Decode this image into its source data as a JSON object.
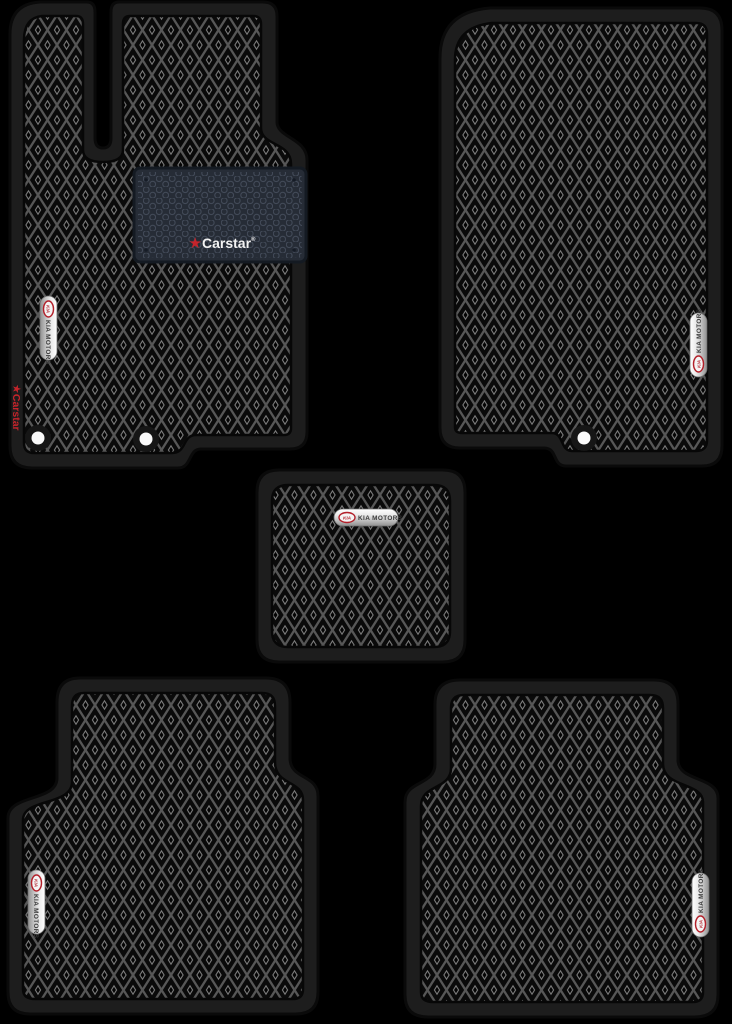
{
  "product": {
    "title": "EVA car floor mat set (5 pieces)"
  },
  "badges": {
    "kia": "KIA",
    "kia_motors": "KIA MOTORS"
  },
  "heel_pad_logo": {
    "star": "★",
    "text": "Carstar",
    "reg": "®"
  },
  "edge_label": {
    "star": "★",
    "text": "Carstar"
  },
  "colors": {
    "background": "#000000",
    "mat_border": "#1d1d1d",
    "mat_surface": "#0a0a0a",
    "pattern_line": "#575757",
    "heel_pad": "#262c36",
    "heel_pad_line": "#424a58",
    "chrome_dark_text": "#3b3b3b",
    "kia_red": "#b3202a",
    "carstar_red": "#c5242b",
    "fastener_white": "#fafafa"
  }
}
